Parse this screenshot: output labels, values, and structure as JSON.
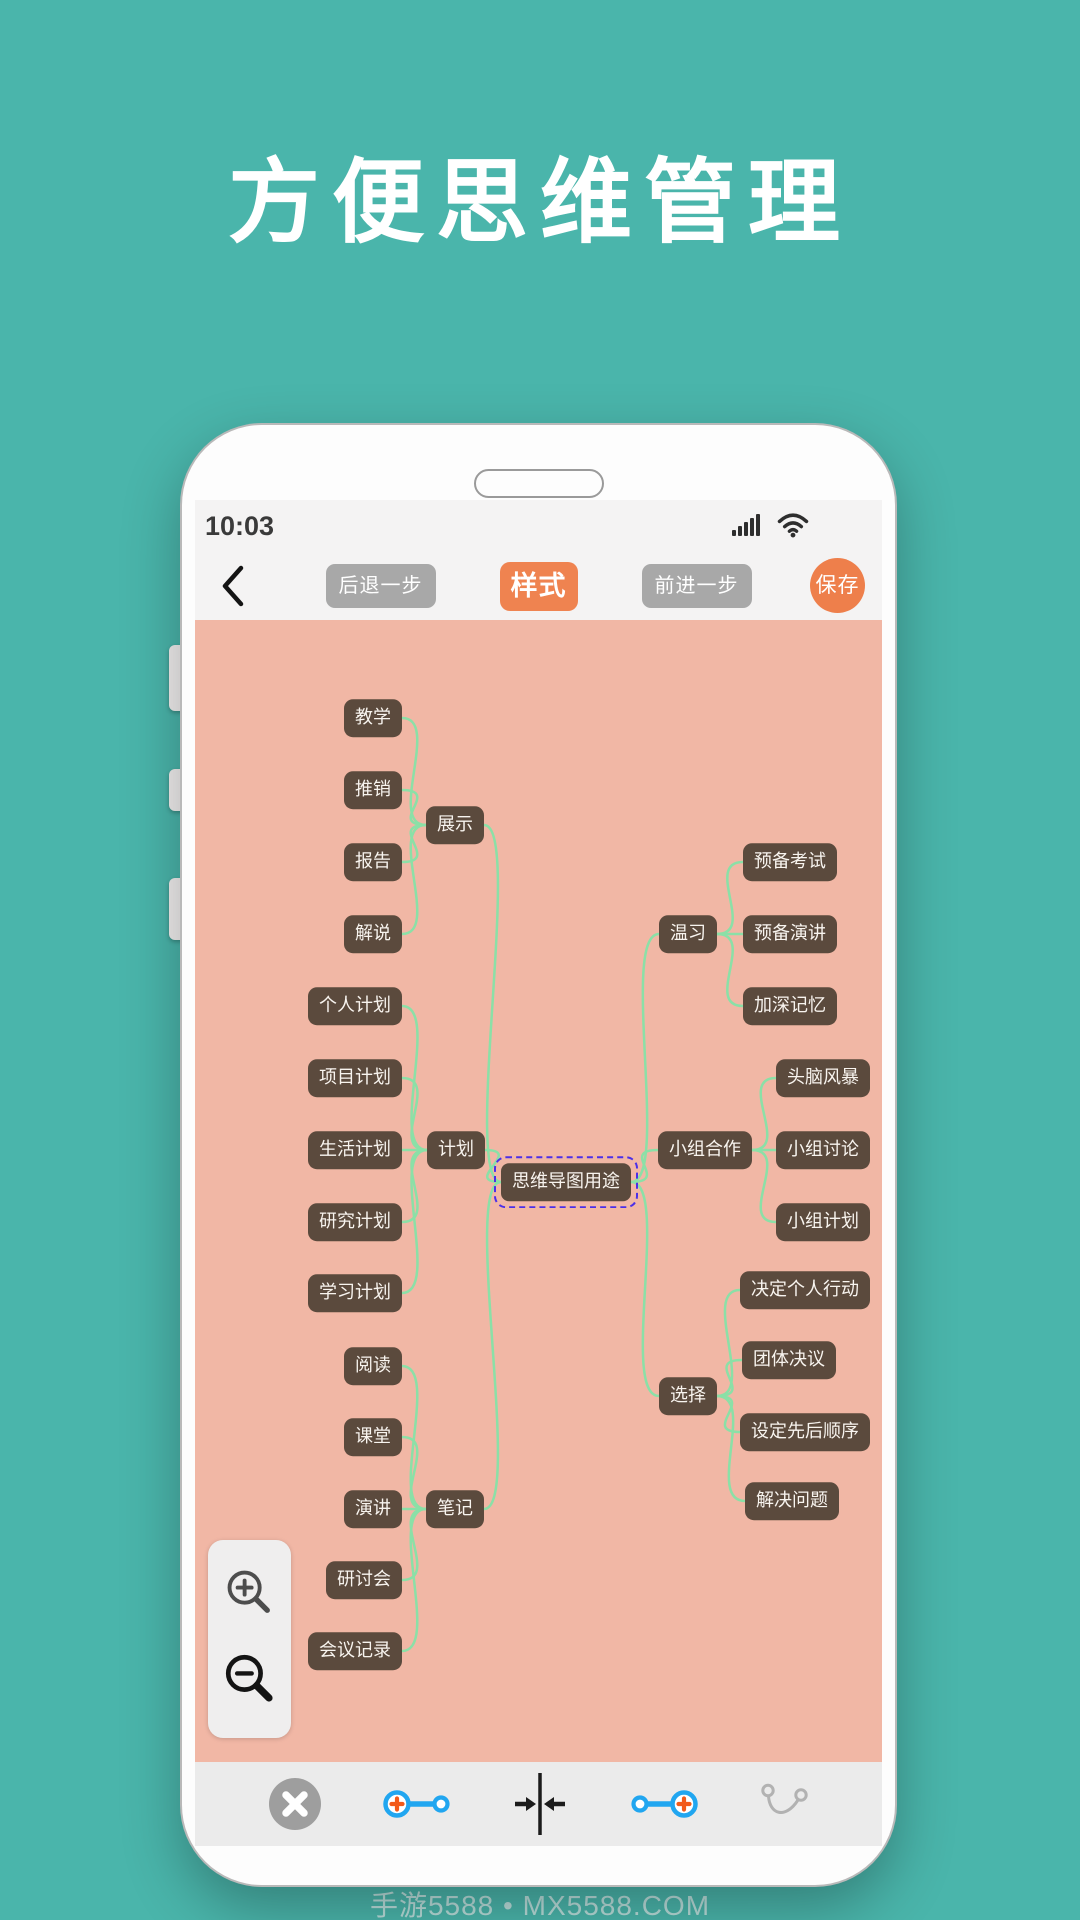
{
  "title": "方便思维管理",
  "watermark": "手游5588 • MX5588.COM",
  "phone": {
    "statusbar": {
      "time": "10:03"
    },
    "toolbar": {
      "undo_label": "后退一步",
      "style_label": "样式",
      "redo_label": "前进一步",
      "save_label": "保存"
    }
  },
  "mindmap": {
    "root_label": "思维导图用途",
    "nodes": [
      {
        "id": "root",
        "label": "思维导图用途",
        "cx": 371,
        "cy": 562,
        "root": true
      },
      {
        "id": "jiaoxue",
        "label": "教学",
        "cx": 178,
        "cy": 98
      },
      {
        "id": "tuixiao",
        "label": "推销",
        "cx": 178,
        "cy": 170
      },
      {
        "id": "zhanshi",
        "label": "展示",
        "cx": 260,
        "cy": 205
      },
      {
        "id": "baogao",
        "label": "报告",
        "cx": 178,
        "cy": 242
      },
      {
        "id": "jieshuo",
        "label": "解说",
        "cx": 178,
        "cy": 314
      },
      {
        "id": "gerenjihua",
        "label": "个人计划",
        "cx": 160,
        "cy": 386
      },
      {
        "id": "xiangmujihua",
        "label": "项目计划",
        "cx": 160,
        "cy": 458
      },
      {
        "id": "shenghuojihua",
        "label": "生活计划",
        "cx": 160,
        "cy": 530
      },
      {
        "id": "jihua",
        "label": "计划",
        "cx": 261,
        "cy": 530
      },
      {
        "id": "yanjiujihua",
        "label": "研究计划",
        "cx": 160,
        "cy": 602
      },
      {
        "id": "xuexijihua",
        "label": "学习计划",
        "cx": 160,
        "cy": 673
      },
      {
        "id": "yuedu",
        "label": "阅读",
        "cx": 178,
        "cy": 746
      },
      {
        "id": "ketang",
        "label": "课堂",
        "cx": 178,
        "cy": 817
      },
      {
        "id": "yanjiang",
        "label": "演讲",
        "cx": 178,
        "cy": 889
      },
      {
        "id": "biji",
        "label": "笔记",
        "cx": 260,
        "cy": 889
      },
      {
        "id": "yantaohui",
        "label": "研讨会",
        "cx": 169,
        "cy": 960
      },
      {
        "id": "huiyijilu",
        "label": "会议记录",
        "cx": 160,
        "cy": 1031
      },
      {
        "id": "wenxi",
        "label": "温习",
        "cx": 493,
        "cy": 314
      },
      {
        "id": "yubeikaoshi",
        "label": "预备考试",
        "cx": 595,
        "cy": 242
      },
      {
        "id": "yubeiyanjiang",
        "label": "预备演讲",
        "cx": 595,
        "cy": 314
      },
      {
        "id": "jiashenjiyi",
        "label": "加深记忆",
        "cx": 595,
        "cy": 386
      },
      {
        "id": "xiaozuhezuo",
        "label": "小组合作",
        "cx": 510,
        "cy": 530
      },
      {
        "id": "tounaofengbao",
        "label": "头脑风暴",
        "cx": 628,
        "cy": 458
      },
      {
        "id": "xiaozutaolun",
        "label": "小组讨论",
        "cx": 628,
        "cy": 530
      },
      {
        "id": "xiaozujihua",
        "label": "小组计划",
        "cx": 628,
        "cy": 602
      },
      {
        "id": "xuanze",
        "label": "选择",
        "cx": 493,
        "cy": 776
      },
      {
        "id": "jueding",
        "label": "决定个人行动",
        "cx": 610,
        "cy": 670
      },
      {
        "id": "tuanti",
        "label": "团体决议",
        "cx": 594,
        "cy": 740
      },
      {
        "id": "sheding",
        "label": "设定先后顺序",
        "cx": 610,
        "cy": 812
      },
      {
        "id": "jiejue",
        "label": "解决问题",
        "cx": 597,
        "cy": 881
      }
    ],
    "edges": [
      [
        "jiaoxue",
        "zhanshi"
      ],
      [
        "tuixiao",
        "zhanshi"
      ],
      [
        "baogao",
        "zhanshi"
      ],
      [
        "jieshuo",
        "zhanshi"
      ],
      [
        "zhanshi",
        "root"
      ],
      [
        "gerenjihua",
        "jihua"
      ],
      [
        "xiangmujihua",
        "jihua"
      ],
      [
        "shenghuojihua",
        "jihua"
      ],
      [
        "yanjiujihua",
        "jihua"
      ],
      [
        "xuexijihua",
        "jihua"
      ],
      [
        "jihua",
        "root"
      ],
      [
        "yuedu",
        "biji"
      ],
      [
        "ketang",
        "biji"
      ],
      [
        "yanjiang",
        "biji"
      ],
      [
        "yantaohui",
        "biji"
      ],
      [
        "huiyijilu",
        "biji"
      ],
      [
        "biji",
        "root"
      ],
      [
        "root",
        "wenxi"
      ],
      [
        "wenxi",
        "yubeikaoshi"
      ],
      [
        "wenxi",
        "yubeiyanjiang"
      ],
      [
        "wenxi",
        "jiashenjiyi"
      ],
      [
        "root",
        "xiaozuhezuo"
      ],
      [
        "xiaozuhezuo",
        "tounaofengbao"
      ],
      [
        "xiaozuhezuo",
        "xiaozutaolun"
      ],
      [
        "xiaozuhezuo",
        "xiaozujihua"
      ],
      [
        "root",
        "xuanze"
      ],
      [
        "xuanze",
        "jueding"
      ],
      [
        "xuanze",
        "tuanti"
      ],
      [
        "xuanze",
        "sheding"
      ],
      [
        "xuanze",
        "jiejue"
      ]
    ]
  },
  "colors": {
    "background_teal": "#4ab5ab",
    "canvas_pink": "#f1b7a5",
    "node_brown": "#5b4a3d",
    "edge_green": "#8be0a7",
    "selection_purple": "#4b2fe8",
    "accent_orange": "#ee8150",
    "button_gray": "#a8a8a8",
    "icon_blue": "#21a6f0",
    "icon_plus_orange": "#f25a1a"
  }
}
